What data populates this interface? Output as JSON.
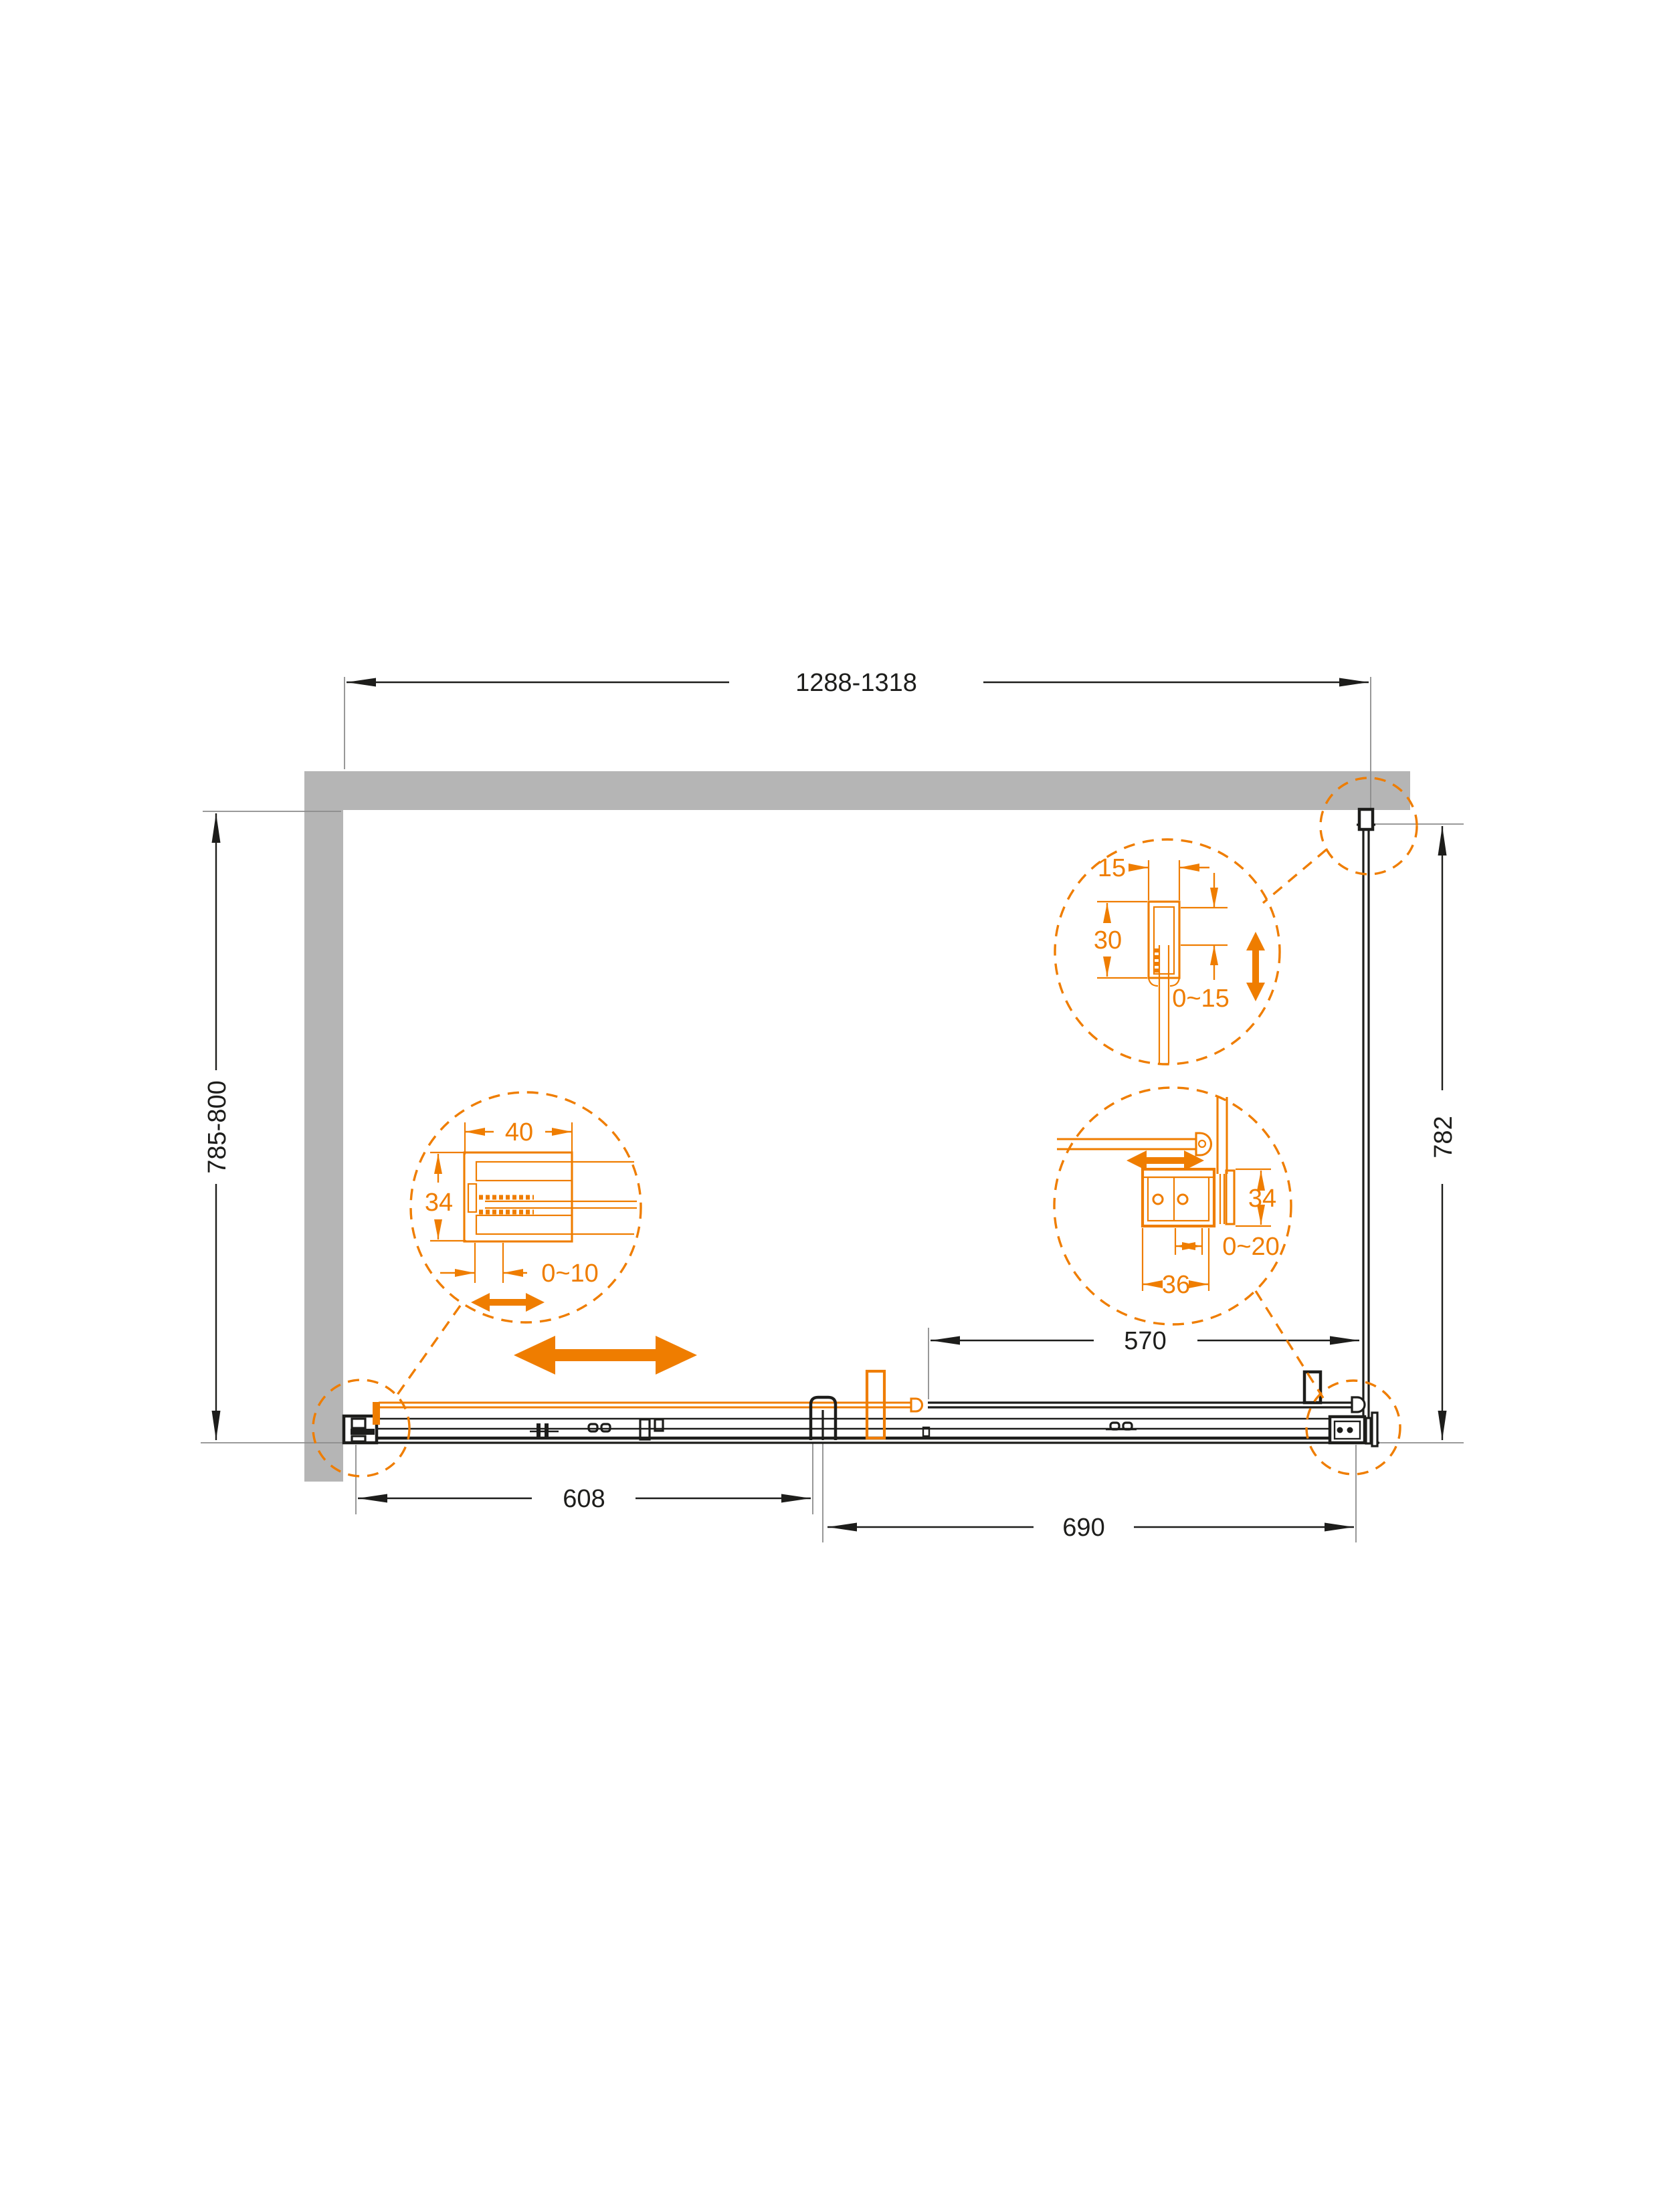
{
  "colors": {
    "accent": "#EF7D00",
    "wall": "#B5B5B5",
    "line": "#1D1D1B",
    "ext": "#8C8C8C",
    "bg": "#FFFFFF"
  },
  "drawing": {
    "type": "shower-enclosure-plan-view-dimension-diagram",
    "overall": {
      "width_range": "1288-1318",
      "depth_range_left": "785-800",
      "depth_fixed_right": "782"
    },
    "bottom": {
      "door_opening": "608",
      "fixed_section": "690",
      "fixed_panel": "570"
    },
    "detail_wall_profile": {
      "width": "40",
      "height": "34",
      "adjustment": "0~10"
    },
    "detail_top_profile": {
      "width": "15",
      "depth": "30",
      "adjustment": "0~15"
    },
    "detail_corner_bracket": {
      "height": "34",
      "adjustment": "0~20",
      "width": "36"
    }
  }
}
